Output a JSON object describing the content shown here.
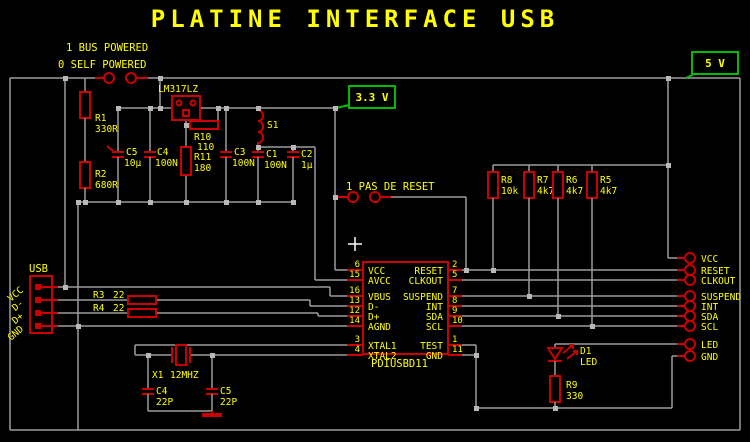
{
  "title": "PLATINE INTERFACE USB",
  "colors": {
    "background": "#000000",
    "wire": "#9c9c9c",
    "component": "#cc0000",
    "text": "#ffff00",
    "voltage_box": "#00bb00",
    "junction": "#b8b8b8",
    "crosshair": "#ffffff"
  },
  "jumpers": {
    "power": {
      "line1": "1 BUS POWERED",
      "line2": "0 SELF POWERED"
    },
    "reset": {
      "label": "1 PAS DE RESET"
    }
  },
  "voltage_labels": {
    "v33": "3.3 V",
    "v5": "5 V"
  },
  "usb": {
    "name": "USB",
    "pin_labels": [
      "VCC",
      "D-",
      "D+",
      "GND"
    ]
  },
  "regulator": {
    "name": "LM317LZ"
  },
  "parts": {
    "r1": {
      "ref": "R1",
      "value": "330R"
    },
    "r2": {
      "ref": "R2",
      "value": "680R"
    },
    "r3": {
      "ref": "R3",
      "value": "22"
    },
    "r4": {
      "ref": "R4",
      "value": "22"
    },
    "r5": {
      "ref": "R5",
      "value": "4k7"
    },
    "r6": {
      "ref": "R6",
      "value": "4k7"
    },
    "r7": {
      "ref": "R7",
      "value": "4k7"
    },
    "r8": {
      "ref": "R8",
      "value": "10k"
    },
    "r9": {
      "ref": "R9",
      "value": "330"
    },
    "r10": {
      "ref": "R10",
      "value": "110"
    },
    "r11": {
      "ref": "R11",
      "value": "180"
    },
    "c1": {
      "ref": "C1",
      "value": "100N"
    },
    "c2": {
      "ref": "C2",
      "value": "1µ"
    },
    "c3": {
      "ref": "C3",
      "value": "100N"
    },
    "c4_top": {
      "ref": "C4",
      "value": "100N"
    },
    "c5_top": {
      "ref": "C5",
      "value": "10µ"
    },
    "c4_bottom": {
      "ref": "C4",
      "value": "22P"
    },
    "c5_bottom": {
      "ref": "C5",
      "value": "22P"
    },
    "s1": {
      "ref": "S1"
    },
    "x1": {
      "ref": "X1",
      "value": "12MHZ"
    },
    "d1": {
      "ref": "D1",
      "value": "LED"
    }
  },
  "ic": {
    "name": "PDIUSBD11",
    "left_pins": [
      {
        "num": "6",
        "label": "VCC"
      },
      {
        "num": "15",
        "label": "AVCC"
      },
      {
        "num": "16",
        "label": "VBUS"
      },
      {
        "num": "13",
        "label": "D-"
      },
      {
        "num": "12",
        "label": "D+"
      },
      {
        "num": "14",
        "label": "AGND"
      },
      {
        "num": "3",
        "label": "XTAL1"
      },
      {
        "num": "4",
        "label": "XTAL2"
      }
    ],
    "right_pins": [
      {
        "num": "2",
        "label": "RESET"
      },
      {
        "num": "5",
        "label": "CLKOUT"
      },
      {
        "num": "7",
        "label": "SUSPEND"
      },
      {
        "num": "8",
        "label": "INT"
      },
      {
        "num": "9",
        "label": "SDA"
      },
      {
        "num": "10",
        "label": "SCL"
      },
      {
        "num": "1",
        "label": "TEST"
      },
      {
        "num": "11",
        "label": "GND"
      }
    ]
  },
  "output_pads": [
    "VCC",
    "RESET",
    "CLKOUT",
    "SUSPEND",
    "INT",
    "SDA",
    "SCL",
    "LED",
    "GND"
  ]
}
